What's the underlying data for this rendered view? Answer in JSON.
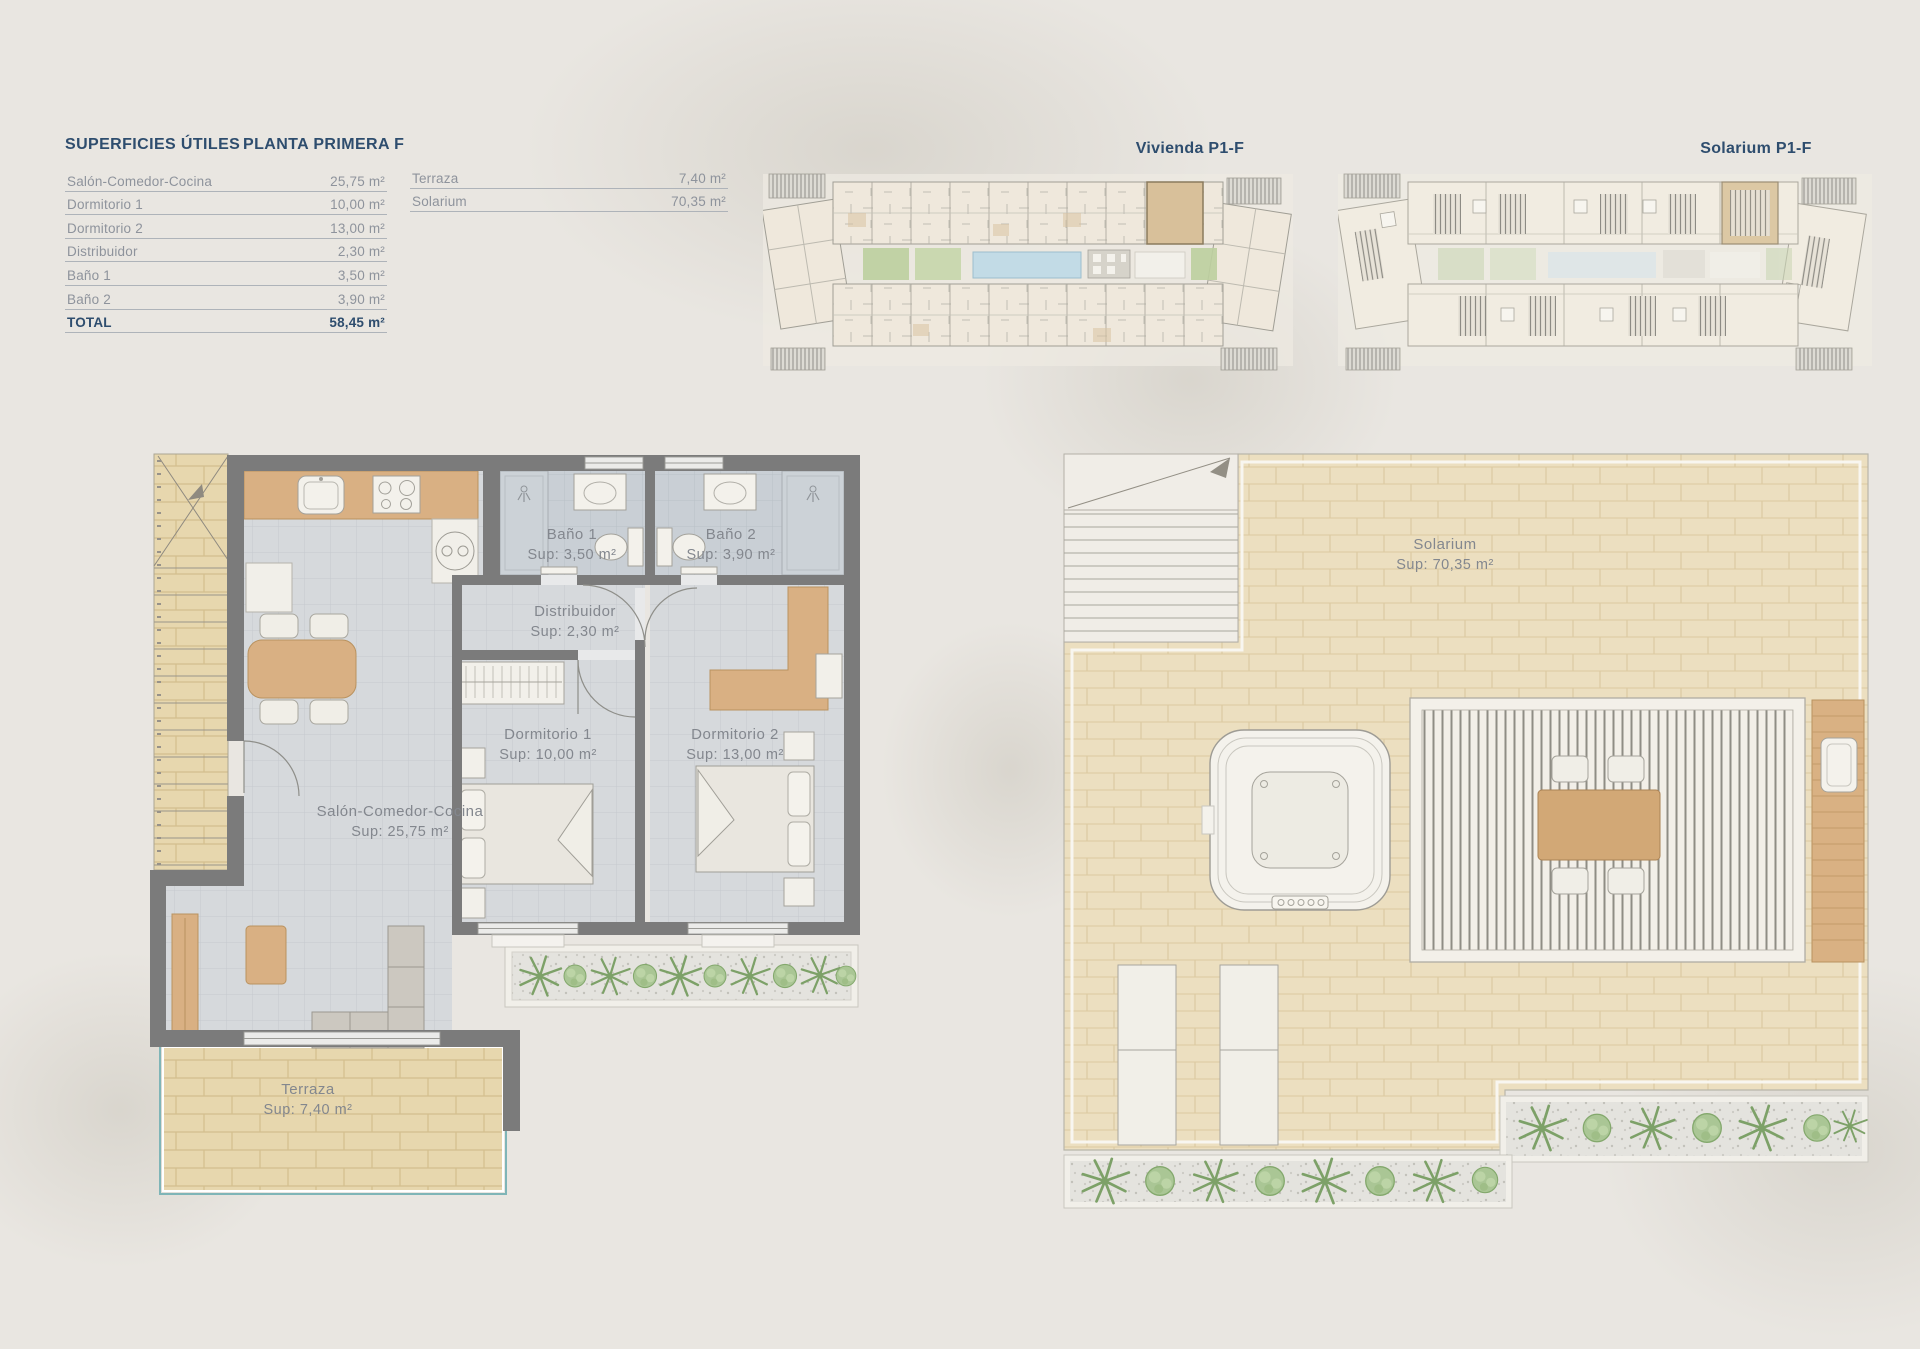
{
  "palette": {
    "accent_navy": "#2e4d6e",
    "muted_text": "#8e939c",
    "wall_gray": "#7b7b7b",
    "floor_gray": "#d6d9dc",
    "bath_gray": "#c9cfd5",
    "wood": "#d9b083",
    "terrace_beige": "#e7d7ae",
    "solarium_beige": "#ecdfc0",
    "plant_green": "#7da168",
    "pool_blue": "#c2dbe6",
    "teal_outline": "#7fb5b7",
    "page_bg": "#e9e6e1"
  },
  "summary": {
    "title": "SUPERFICIES ÚTILES",
    "plan_name": "PLANTA PRIMERA F",
    "rows": [
      {
        "label": "Salón-Comedor-Cocina",
        "value": "25,75 m²"
      },
      {
        "label": "Dormitorio 1",
        "value": "10,00 m²"
      },
      {
        "label": "Dormitorio 2",
        "value": "13,00 m²"
      },
      {
        "label": "Distribuidor",
        "value": "2,30 m²"
      },
      {
        "label": "Baño 1",
        "value": "3,50 m²"
      },
      {
        "label": "Baño 2",
        "value": "3,90 m²"
      }
    ],
    "total_row": {
      "label": "TOTAL",
      "value": "58,45 m²"
    },
    "exterior_rows": [
      {
        "label": "Terraza",
        "value": "7,40 m²"
      },
      {
        "label": "Solarium",
        "value": "70,35 m²"
      }
    ]
  },
  "overview": {
    "vivienda_title": "Vivienda P1-F",
    "solarium_title": "Solarium P1-F"
  },
  "floor_plan": {
    "bano1": {
      "name": "Baño 1",
      "sup": "Sup: 3,50 m²"
    },
    "bano2": {
      "name": "Baño 2",
      "sup": "Sup: 3,90 m²"
    },
    "distribuidor": {
      "name": "Distribuidor",
      "sup": "Sup: 2,30 m²"
    },
    "dormitorio1": {
      "name": "Dormitorio 1",
      "sup": "Sup: 10,00 m²"
    },
    "dormitorio2": {
      "name": "Dormitorio 2",
      "sup": "Sup: 13,00 m²"
    },
    "salon": {
      "name": "Salón-Comedor-Cocina",
      "sup": "Sup: 25,75 m²"
    },
    "terraza": {
      "name": "Terraza",
      "sup": "Sup: 7,40 m²"
    }
  },
  "solarium_plan": {
    "solarium": {
      "name": "Solarium",
      "sup": "Sup: 70,35 m²"
    }
  }
}
